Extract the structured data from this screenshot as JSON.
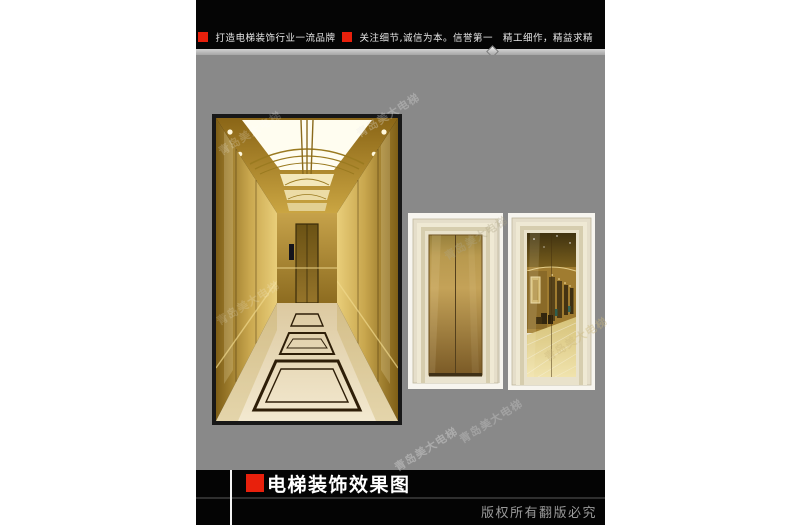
{
  "header": {
    "slogan_brand": "打造电梯装饰行业一流品牌",
    "slogan_values": "关注细节,诚信为本。信誉第一　精工细作，精益求精"
  },
  "footer": {
    "title": "电梯装饰效果图",
    "copyright": "版权所有翻版必究"
  },
  "watermark": {
    "text": "青岛美大电梯"
  },
  "colors": {
    "accent_red": "#e8200c",
    "panel_gray": "#898989",
    "bar_black": "#050505",
    "elevator_gold": "#c9a43e",
    "door_brass": "#b7954c",
    "frame_cream": "#e8e1ca",
    "title_white": "#ffffff",
    "copyright_gray": "#9a9a9a"
  }
}
